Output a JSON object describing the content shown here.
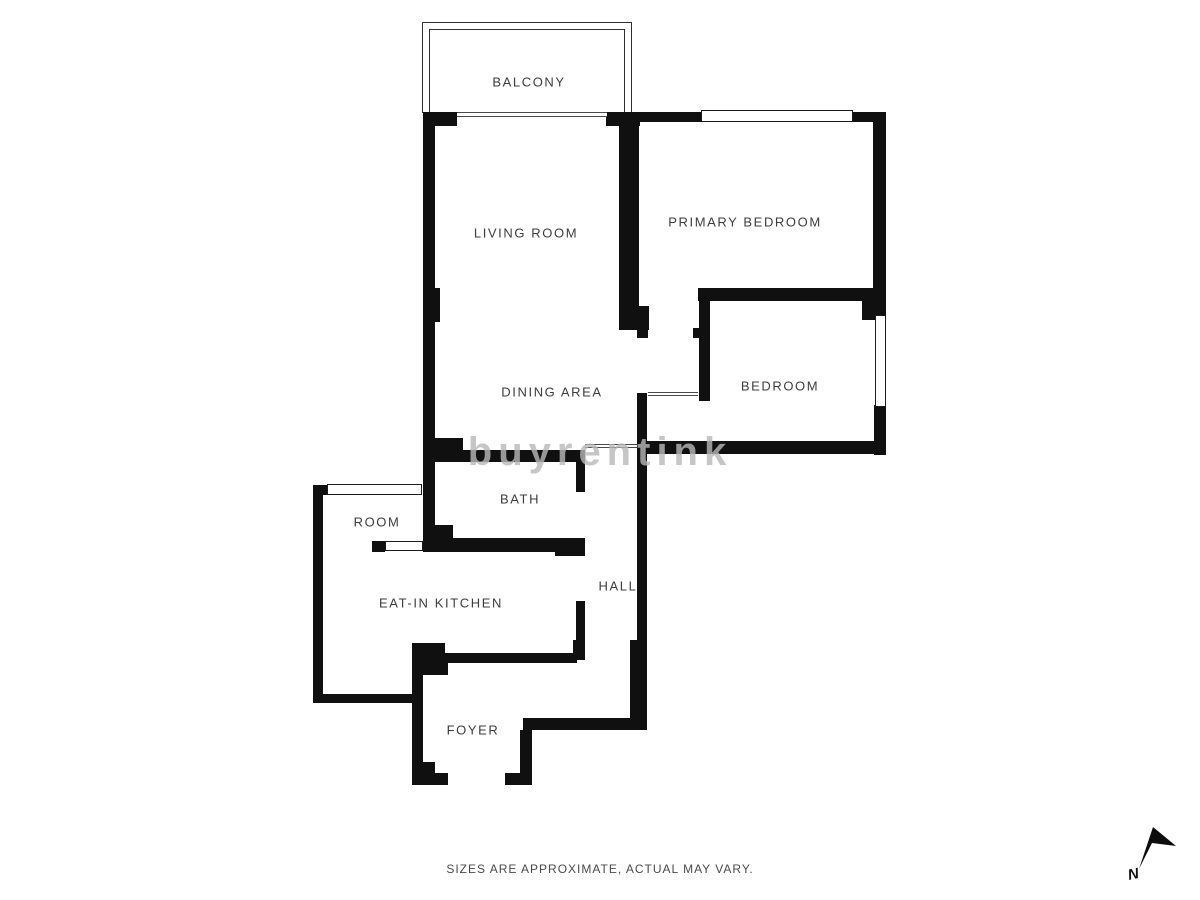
{
  "page": {
    "footer_note": "SIZES ARE APPROXIMATE, ACTUAL MAY VARY.",
    "watermark_text": "buyrentink",
    "compass_label": "N"
  },
  "colors": {
    "wall": "#101010",
    "label_text": "#3d3d3d",
    "footer_text": "#4a4a4a",
    "watermark": "#b9b9b9",
    "background": "#ffffff"
  },
  "floorplan": {
    "rooms": [
      {
        "label": "BALCONY",
        "cx": 529,
        "cy": 82
      },
      {
        "label": "LIVING ROOM",
        "cx": 526,
        "cy": 233
      },
      {
        "label": "PRIMARY BEDROOM",
        "cx": 745,
        "cy": 222
      },
      {
        "label": "DINING AREA",
        "cx": 552,
        "cy": 392
      },
      {
        "label": "BEDROOM",
        "cx": 780,
        "cy": 386
      },
      {
        "label": "BATH",
        "cx": 520,
        "cy": 499
      },
      {
        "label": "ROOM",
        "cx": 377,
        "cy": 522
      },
      {
        "label": "EAT-IN KITCHEN",
        "cx": 441,
        "cy": 603
      },
      {
        "label": "HALL",
        "cx": 618,
        "cy": 586
      },
      {
        "label": "FOYER",
        "cx": 473,
        "cy": 730
      }
    ],
    "walls": [
      [
        423,
        112,
        34,
        14
      ],
      [
        606,
        112,
        34,
        14
      ],
      [
        633,
        112,
        68,
        10
      ],
      [
        853,
        112,
        33,
        10
      ],
      [
        873,
        112,
        13,
        192
      ],
      [
        698,
        288,
        188,
        13
      ],
      [
        862,
        288,
        24,
        32
      ],
      [
        874,
        300,
        12,
        17
      ],
      [
        874,
        405,
        12,
        50
      ],
      [
        638,
        441,
        248,
        13
      ],
      [
        699,
        288,
        11,
        113
      ],
      [
        693,
        328,
        7,
        10
      ],
      [
        423,
        112,
        12,
        440
      ],
      [
        423,
        288,
        17,
        34
      ],
      [
        619,
        112,
        20,
        194
      ],
      [
        619,
        306,
        30,
        24
      ],
      [
        637,
        322,
        11,
        16
      ],
      [
        423,
        438,
        40,
        16
      ],
      [
        430,
        450,
        155,
        12
      ],
      [
        576,
        453,
        9,
        39
      ],
      [
        555,
        538,
        30,
        18
      ],
      [
        432,
        538,
        146,
        14
      ],
      [
        423,
        525,
        30,
        27
      ],
      [
        313,
        485,
        14,
        10
      ],
      [
        313,
        485,
        10,
        218
      ],
      [
        313,
        694,
        106,
        9
      ],
      [
        372,
        541,
        13,
        11
      ],
      [
        412,
        643,
        11,
        142
      ],
      [
        415,
        643,
        30,
        13
      ],
      [
        423,
        655,
        25,
        20
      ],
      [
        433,
        653,
        144,
        10
      ],
      [
        573,
        640,
        12,
        20
      ],
      [
        576,
        601,
        9,
        59
      ],
      [
        412,
        762,
        23,
        23
      ],
      [
        412,
        773,
        36,
        12
      ],
      [
        505,
        773,
        27,
        12
      ],
      [
        520,
        730,
        12,
        55
      ],
      [
        523,
        718,
        124,
        12
      ],
      [
        637,
        393,
        10,
        327
      ],
      [
        630,
        640,
        17,
        90
      ]
    ],
    "windows": [
      [
        701,
        110,
        152,
        12
      ],
      [
        875,
        315,
        11,
        92
      ],
      [
        327,
        484,
        95,
        11
      ],
      [
        385,
        541,
        38,
        10
      ]
    ],
    "thresholds": [
      [
        457,
        112,
        150,
        5
      ],
      [
        585,
        444,
        52,
        4
      ],
      [
        648,
        392,
        50,
        4
      ]
    ],
    "balcony": {
      "outer": [
        422,
        22,
        210,
        91
      ],
      "inner": [
        429,
        29,
        196,
        84
      ]
    }
  }
}
